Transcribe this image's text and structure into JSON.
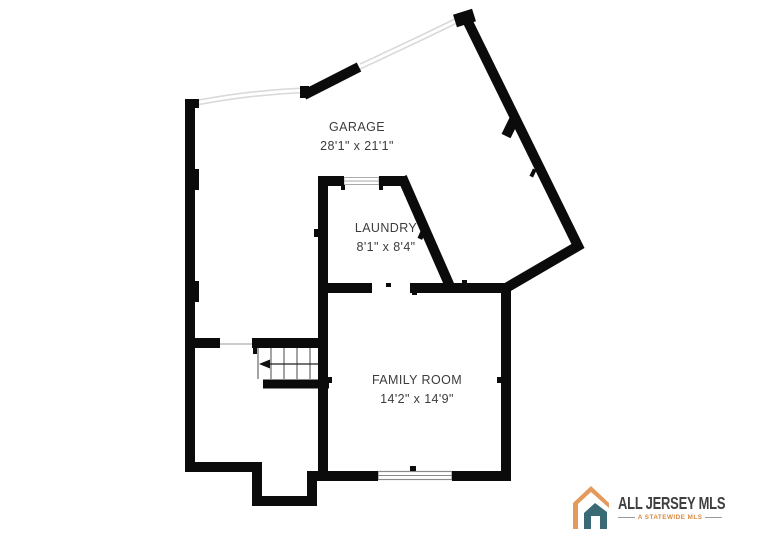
{
  "plan": {
    "wall_color": "#0b0b0b",
    "rooms": [
      {
        "id": "garage",
        "name": "GARAGE",
        "dimensions": "28'1\" x 21'1\""
      },
      {
        "id": "laundry",
        "name": "LAUNDRY",
        "dimensions": "8'1\" x 8'4\""
      },
      {
        "id": "family-room",
        "name": "FAMILY ROOM",
        "dimensions": "14'2\" x 14'9\""
      }
    ],
    "features": {
      "stairs": "staircase-with-left-arrow",
      "garage_doors": "double-thin-line-openings",
      "window": "family-room-bottom-window"
    }
  },
  "branding": {
    "logo_text": "ALL JERSEY MLS",
    "tagline": "A STATEWIDE MLS",
    "icon": "house-logo-icon",
    "colors": {
      "orange": "#E49A5B",
      "teal": "#3A6B75",
      "text": "#3f3f3f",
      "tagline": "#D98A3F"
    }
  }
}
